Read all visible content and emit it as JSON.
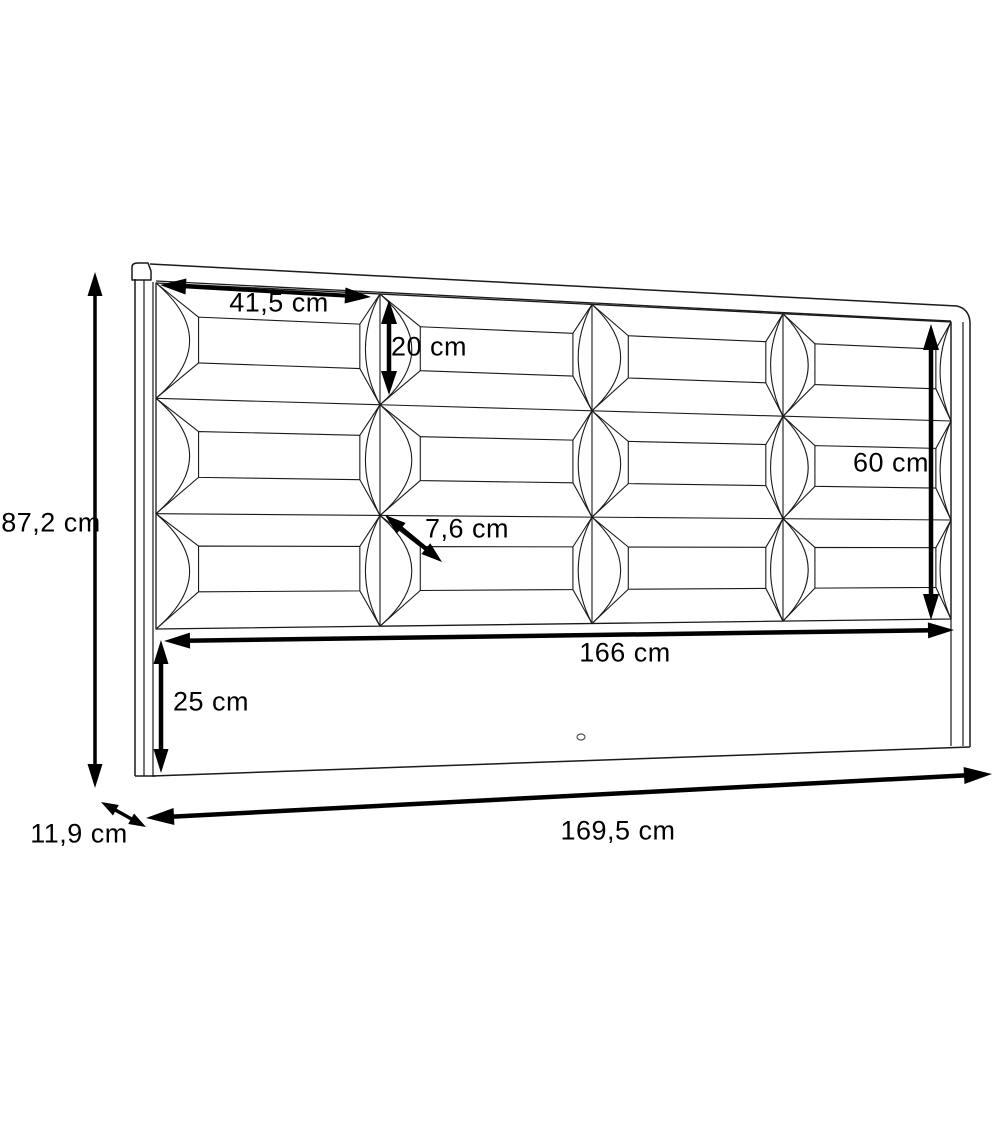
{
  "diagram": {
    "type": "technical-drawing",
    "subject": "upholstered headboard with padded panel grid",
    "unit": "cm",
    "background": "#ffffff",
    "line_color": "#000000",
    "grid": {
      "columns": 4,
      "rows": 3
    },
    "dimensions": [
      {
        "id": "overall-height",
        "label": "87,2 cm",
        "value_cm": 87.2,
        "arrow": {
          "x1": 95,
          "y1": 272,
          "x2": 95,
          "y2": 788,
          "sw": 3.5,
          "hl": 24,
          "hw": 15
        },
        "label_pos": {
          "x": 51,
          "y": 523
        }
      },
      {
        "id": "panel-width",
        "label": "41,5 cm",
        "value_cm": 41.5,
        "arrow": {
          "x1": 160,
          "y1": 285,
          "x2": 371,
          "y2": 297,
          "sw": 4,
          "hl": 26,
          "hw": 16
        },
        "label_pos": {
          "x": 279,
          "y": 303
        }
      },
      {
        "id": "panel-height",
        "label": "20 cm",
        "value_cm": 20,
        "arrow": {
          "x1": 389,
          "y1": 300,
          "x2": 389,
          "y2": 395,
          "sw": 4.5,
          "hl": 24,
          "hw": 16
        },
        "label_pos": {
          "x": 429,
          "y": 347
        }
      },
      {
        "id": "padded-height",
        "label": "60 cm",
        "value_cm": 60,
        "arrow": {
          "x1": 931,
          "y1": 324,
          "x2": 931,
          "y2": 620,
          "sw": 4.5,
          "hl": 26,
          "hw": 16
        },
        "label_pos": {
          "x": 891,
          "y": 463
        }
      },
      {
        "id": "panel-depth",
        "label": "7,6 cm",
        "value_cm": 7.6,
        "arrow": {
          "x1": 385,
          "y1": 515,
          "x2": 442,
          "y2": 562,
          "sw": 4.5,
          "hl": 21,
          "hw": 14
        },
        "label_pos": {
          "x": 467,
          "y": 529
        }
      },
      {
        "id": "inner-width",
        "label": "166 cm",
        "value_cm": 166,
        "arrow": {
          "x1": 164,
          "y1": 641,
          "x2": 954,
          "y2": 630,
          "sw": 4.5,
          "hl": 26,
          "hw": 16
        },
        "label_pos": {
          "x": 625,
          "y": 653
        }
      },
      {
        "id": "bottom-rail-height",
        "label": "25 cm",
        "value_cm": 25,
        "arrow": {
          "x1": 161,
          "y1": 640,
          "x2": 161,
          "y2": 773,
          "sw": 4.5,
          "hl": 24,
          "hw": 15
        },
        "label_pos": {
          "x": 211,
          "y": 702
        }
      },
      {
        "id": "side-depth",
        "label": "11,9 cm",
        "value_cm": 11.9,
        "arrow": {
          "x1": 101,
          "y1": 802,
          "x2": 146,
          "y2": 827,
          "sw": 3.5,
          "hl": 17,
          "hw": 12
        },
        "label_pos": {
          "x": 79,
          "y": 834
        }
      },
      {
        "id": "overall-width",
        "label": "169,5 cm",
        "value_cm": 169.5,
        "arrow": {
          "x1": 146,
          "y1": 818,
          "x2": 992,
          "y2": 774,
          "sw": 4.5,
          "hl": 28,
          "hw": 17
        },
        "label_pos": {
          "x": 618,
          "y": 831
        }
      }
    ]
  }
}
